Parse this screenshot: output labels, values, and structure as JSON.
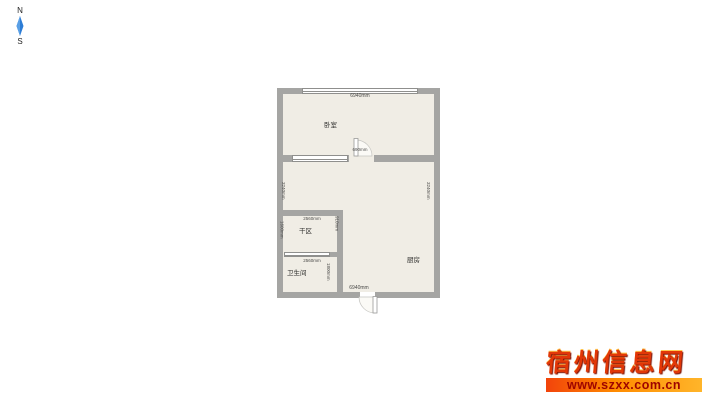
{
  "compass": {
    "north_label": "N",
    "south_label": "S"
  },
  "plan": {
    "rooms": {
      "bedroom": "卧室",
      "kitchen": "厨房",
      "dry_area": "干区",
      "bathroom": "卫生间"
    },
    "dims": {
      "top_width": "6940mm",
      "bottom_width": "6940mm",
      "left_height": "3240mm",
      "right_height": "3240mm",
      "bedroom_door": "690mm",
      "dry_area_width": "2560mm",
      "dry_area_right": "910mm",
      "dry_area_left": "1600mm",
      "bathroom_width": "2560mm",
      "bathroom_right": "1800mm"
    },
    "colors": {
      "wall": "#a5a5a3",
      "floor": "#f0ede5",
      "window_border": "#8f8f8d",
      "dim_text": "#4a4a48"
    }
  },
  "watermark": {
    "site_name": "宿州信息网",
    "url": "www.szxx.com.cn",
    "name_color": "#e23708",
    "bar_gradient": [
      "#f2430b",
      "#ff8c00",
      "#ffb52a"
    ],
    "url_color": "#9e0400"
  }
}
